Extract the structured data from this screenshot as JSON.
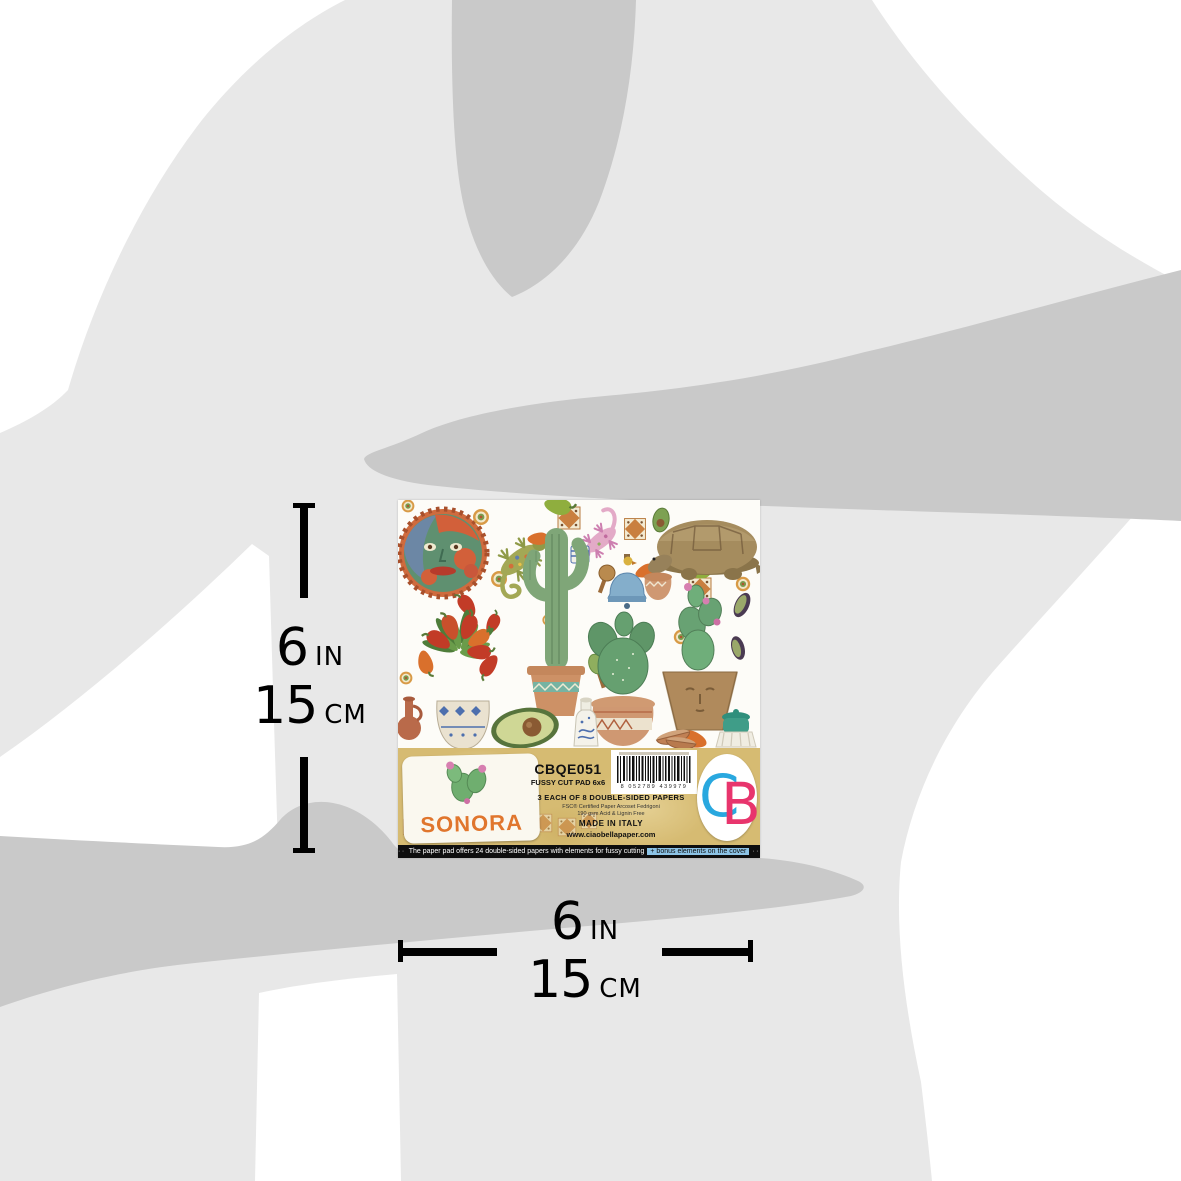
{
  "product": {
    "collection": "SONORA",
    "code": "CBQE051",
    "type_line": "FUSSY CUT PAD 6x6",
    "contents_line": "3 EACH OF 8 DOUBLE-SIDED PAPERS",
    "cert_line": "FSC® Certified Paper Arcoset Fedrigoni",
    "paper_line": "190 gsm Acid & Lignin Free",
    "made_in": "MADE IN ITALY",
    "website": "www.ciaobellapaper.com",
    "barcode_digits": "8 052789 439979",
    "brand_initial_c": "C",
    "brand_initial_b": "B",
    "strip": {
      "prefix_dots": "·····",
      "text": "The paper pad offers 24 double-sided papers with elements for fussy cutting",
      "highlight": "+ bonus elements on the cover",
      "suffix_dots": "·····"
    }
  },
  "measurements": {
    "vertical": {
      "value_in": "6",
      "unit_in": "IN",
      "value_cm": "15",
      "unit_cm": "CM"
    },
    "horizontal": {
      "value_in": "6",
      "unit_in": "IN",
      "value_cm": "15",
      "unit_cm": "CM"
    }
  },
  "colors": {
    "silhouette_light": "#e8e8e8",
    "silhouette_dark": "#c9c9c9",
    "band_gold": "#d6bb72",
    "sonora_orange": "#e0762d",
    "brand_c_cyan": "#29a8df",
    "brand_b_pink": "#e8356d",
    "strip_black": "#0e0e0e",
    "highlight_blue": "#8cc3e6",
    "marker_black": "#000000"
  },
  "collage_items": [
    "sun-face",
    "green-gecko",
    "pink-gecko",
    "saguaro-cactus-in-pot",
    "blue-bell-with-bird",
    "tortoise",
    "prickly-pear-in-round-pot",
    "prickly-pear-in-face-pot",
    "chili-pepper-plant-in-talavera-pot",
    "avocado-half",
    "avocado-slices",
    "terracotta-bottle",
    "white-ceramic-bottle",
    "green-jar",
    "terracotta-pot",
    "stacked-bowls",
    "maracas",
    "blue-cup",
    "decorative-tiles",
    "medallions",
    "chili-peppers"
  ]
}
